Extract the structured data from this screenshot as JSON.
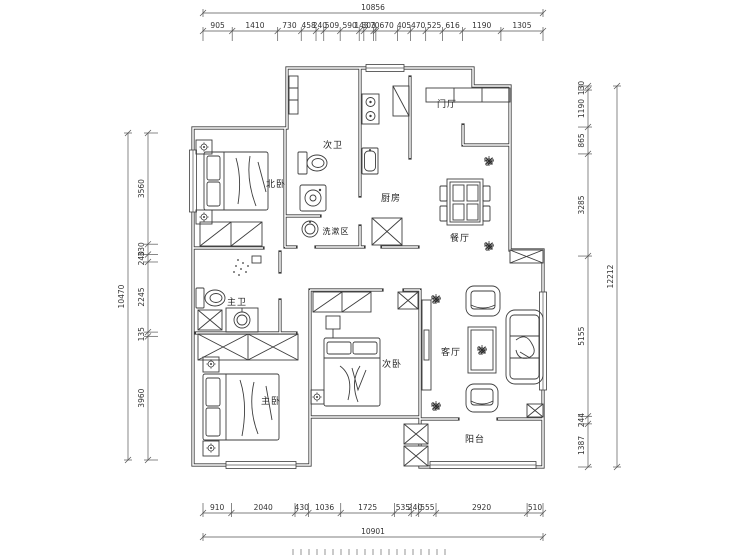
{
  "rooms": {
    "second_bath": {
      "label": "次卫"
    },
    "north_bedroom": {
      "label": "北卧"
    },
    "wash_area": {
      "label": "洗漱区"
    },
    "kitchen": {
      "label": "厨房"
    },
    "entry": {
      "label": "门厅"
    },
    "dining": {
      "label": "餐厅"
    },
    "master_bath": {
      "label": "主卫"
    },
    "master_bedroom": {
      "label": "主卧"
    },
    "second_bedroom": {
      "label": "次卧"
    },
    "living": {
      "label": "客厅"
    },
    "balcony": {
      "label": "阳台"
    }
  },
  "dimensions": {
    "top_total": "10856",
    "top": [
      "905",
      "1410",
      "730",
      "458",
      "240",
      "509",
      "590",
      "143",
      "303",
      "70",
      "670",
      "405",
      "470",
      "525",
      "616",
      "1190",
      "1305"
    ],
    "bottom": [
      "910",
      "2040",
      "430",
      "1036",
      "1725",
      "535",
      "240",
      "555",
      "2920",
      "510"
    ],
    "bottom_total": "10901",
    "left": [
      "3560",
      "330",
      "240",
      "2245",
      "135",
      "3960"
    ],
    "left_total": "10470",
    "right": [
      "130",
      "1190",
      "865",
      "3285",
      "5155",
      "244",
      "1387"
    ],
    "right_total": "12212"
  },
  "colors": {
    "line": "#3d3d3d",
    "wall": "#3a3a3a",
    "dim": "#333333",
    "background": "#ffffff"
  }
}
